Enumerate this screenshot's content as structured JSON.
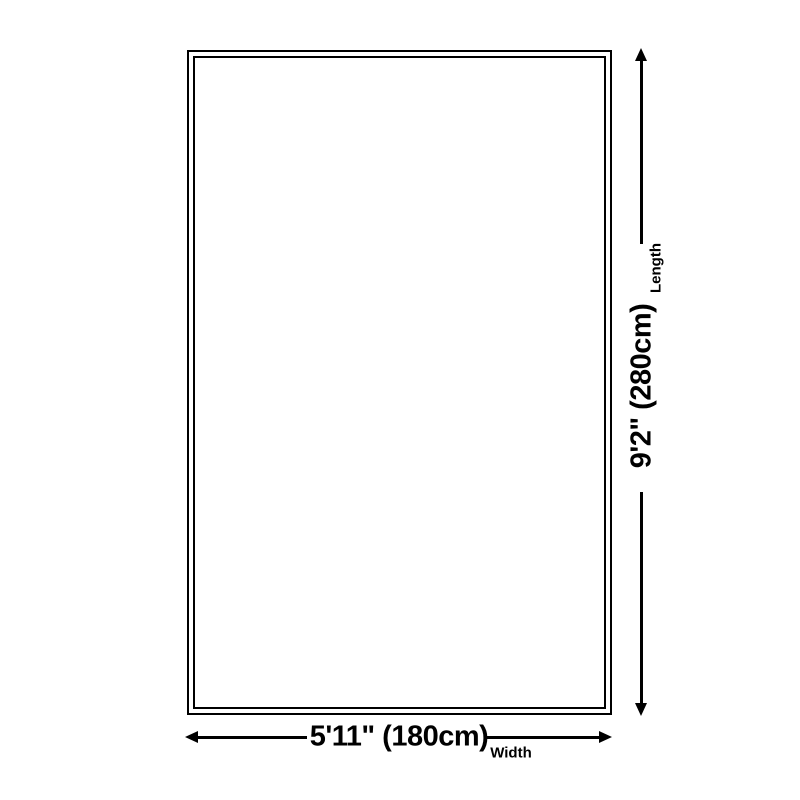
{
  "diagram": {
    "background_color": "#ffffff",
    "line_color": "#000000",
    "length": {
      "value": "9'2\" (280cm)",
      "label": "Length"
    },
    "width": {
      "value": "5'11\" (180cm)",
      "label": "Width"
    }
  }
}
